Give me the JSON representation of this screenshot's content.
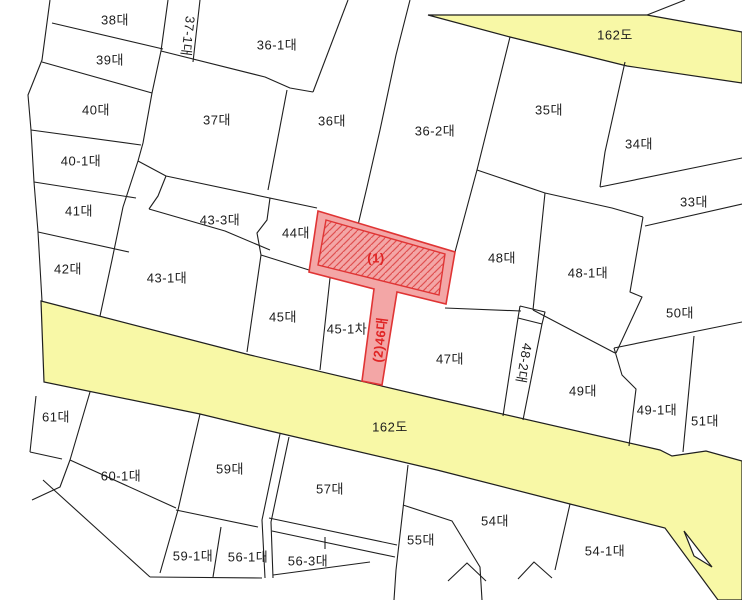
{
  "map_type": "cadastral-parcel-map",
  "colors": {
    "background": "#ffffff",
    "boundary_line": "#1f1f1f",
    "road_fill": "#f8f8a6",
    "highlight_fill": "#f3a6a6",
    "highlight_stroke": "#e03434",
    "highlight_hatch": "#e05050",
    "label": "#1c1c1c",
    "highlight_label": "#e02525"
  },
  "roads": [
    {
      "label": "162도",
      "x": 615,
      "y": 36,
      "rotate": 0
    },
    {
      "label": "162도",
      "x": 390,
      "y": 428,
      "rotate": 0
    }
  ],
  "highlight": {
    "labels": [
      {
        "text": "(1)",
        "x": 376,
        "y": 259,
        "rotate": 0
      },
      {
        "text": "(2)46대",
        "x": 381,
        "y": 340,
        "rotate": -83
      }
    ]
  },
  "parcels": [
    {
      "label": "38대",
      "x": 115,
      "y": 21,
      "rotate": 0
    },
    {
      "label": "39대",
      "x": 110,
      "y": 61,
      "rotate": 0
    },
    {
      "label": "37-1대",
      "x": 187,
      "y": 36,
      "rotate": 97
    },
    {
      "label": "36-1대",
      "x": 277,
      "y": 46,
      "rotate": 0
    },
    {
      "label": "40대",
      "x": 96,
      "y": 111,
      "rotate": 0
    },
    {
      "label": "37대",
      "x": 217,
      "y": 121,
      "rotate": 0
    },
    {
      "label": "36대",
      "x": 332,
      "y": 122,
      "rotate": 0
    },
    {
      "label": "36-2대",
      "x": 435,
      "y": 132,
      "rotate": 0
    },
    {
      "label": "35대",
      "x": 549,
      "y": 111,
      "rotate": 0
    },
    {
      "label": "34대",
      "x": 639,
      "y": 145,
      "rotate": 0
    },
    {
      "label": "40-1대",
      "x": 81,
      "y": 162,
      "rotate": 0
    },
    {
      "label": "41대",
      "x": 79,
      "y": 212,
      "rotate": 0
    },
    {
      "label": "43-3대",
      "x": 220,
      "y": 221,
      "rotate": 0
    },
    {
      "label": "33대",
      "x": 694,
      "y": 203,
      "rotate": 0
    },
    {
      "label": "44대",
      "x": 296,
      "y": 234,
      "rotate": 0
    },
    {
      "label": "48대",
      "x": 502,
      "y": 259,
      "rotate": 0
    },
    {
      "label": "48-1대",
      "x": 588,
      "y": 274,
      "rotate": 0
    },
    {
      "label": "42대",
      "x": 68,
      "y": 270,
      "rotate": 0
    },
    {
      "label": "43-1대",
      "x": 167,
      "y": 279,
      "rotate": 0
    },
    {
      "label": "50대",
      "x": 680,
      "y": 314,
      "rotate": 0
    },
    {
      "label": "45대",
      "x": 283,
      "y": 318,
      "rotate": 0
    },
    {
      "label": "45-1차",
      "x": 347,
      "y": 330,
      "rotate": 0
    },
    {
      "label": "47대",
      "x": 450,
      "y": 360,
      "rotate": 0
    },
    {
      "label": "48-2대",
      "x": 523,
      "y": 363,
      "rotate": 100
    },
    {
      "label": "49대",
      "x": 583,
      "y": 392,
      "rotate": 0
    },
    {
      "label": "49-1대",
      "x": 657,
      "y": 411,
      "rotate": 0
    },
    {
      "label": "51대",
      "x": 705,
      "y": 422,
      "rotate": 0
    },
    {
      "label": "61대",
      "x": 56,
      "y": 418,
      "rotate": 0
    },
    {
      "label": "60-1대",
      "x": 121,
      "y": 477,
      "rotate": 0
    },
    {
      "label": "59대",
      "x": 230,
      "y": 470,
      "rotate": 0
    },
    {
      "label": "57대",
      "x": 330,
      "y": 490,
      "rotate": 0
    },
    {
      "label": "55대",
      "x": 421,
      "y": 541,
      "rotate": 0
    },
    {
      "label": "54대",
      "x": 495,
      "y": 522,
      "rotate": 0
    },
    {
      "label": "54-1대",
      "x": 605,
      "y": 552,
      "rotate": 0
    },
    {
      "label": "59-1대",
      "x": 193,
      "y": 557,
      "rotate": 0
    },
    {
      "label": "56-1대",
      "x": 248,
      "y": 558,
      "rotate": 0
    },
    {
      "label": "56-3대",
      "x": 308,
      "y": 562,
      "rotate": 0
    }
  ]
}
